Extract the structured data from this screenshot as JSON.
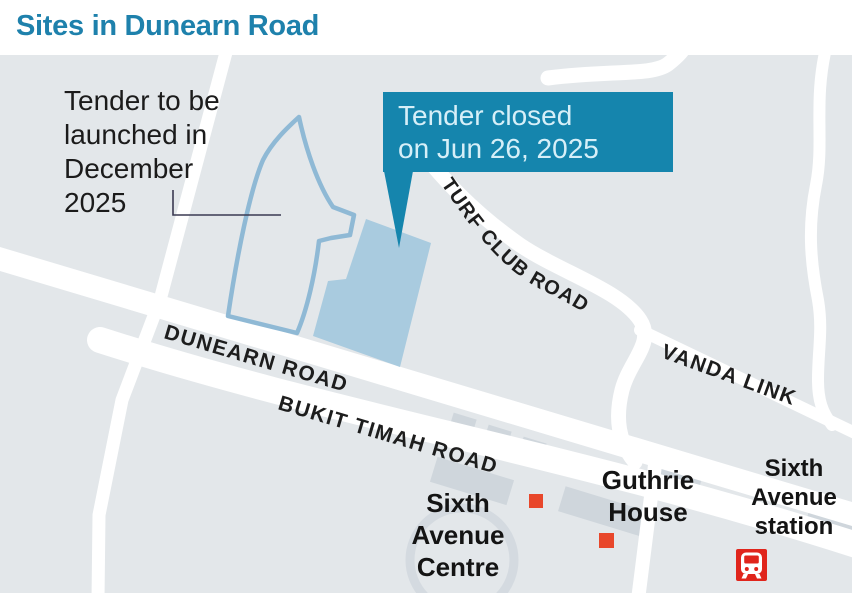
{
  "title": "Sites in Dunearn Road",
  "colors": {
    "title_blue": "#1e81ac",
    "map_bg": "#e3e7ea",
    "road_white": "#ffffff",
    "building_gray": "#cfd6dc",
    "site_fill": "#a9cbdf",
    "site_outline": "#8fb9d5",
    "callout_bg": "#1585ad",
    "callout_text": "#d6eff8",
    "label_dark": "#1b1b1b",
    "marker_orange": "#e8472b",
    "mrt_red": "#e0251c",
    "leader_line": "#3a3a52"
  },
  "annotations": {
    "upcoming": {
      "lines": [
        "Tender to be",
        "launched in",
        "December",
        "2025"
      ]
    },
    "closed": {
      "lines": [
        "Tender closed",
        "on Jun 26, 2025"
      ]
    }
  },
  "roads": {
    "dunearn": "DUNEARN ROAD",
    "bukit_timah": "BUKIT TIMAH ROAD",
    "turf_club": "TURF CLUB ROAD",
    "vanda_link": "VANDA LINK"
  },
  "places": {
    "sixth_avenue_centre": {
      "lines": [
        "Sixth",
        "Avenue",
        "Centre"
      ]
    },
    "guthrie_house": {
      "lines": [
        "Guthrie",
        "House"
      ]
    },
    "sixth_avenue_station": {
      "lines": [
        "Sixth",
        "Avenue",
        "station"
      ]
    }
  },
  "icons": {
    "station_icon": "mrt-train-icon",
    "site_markers": "building-marker-square"
  }
}
